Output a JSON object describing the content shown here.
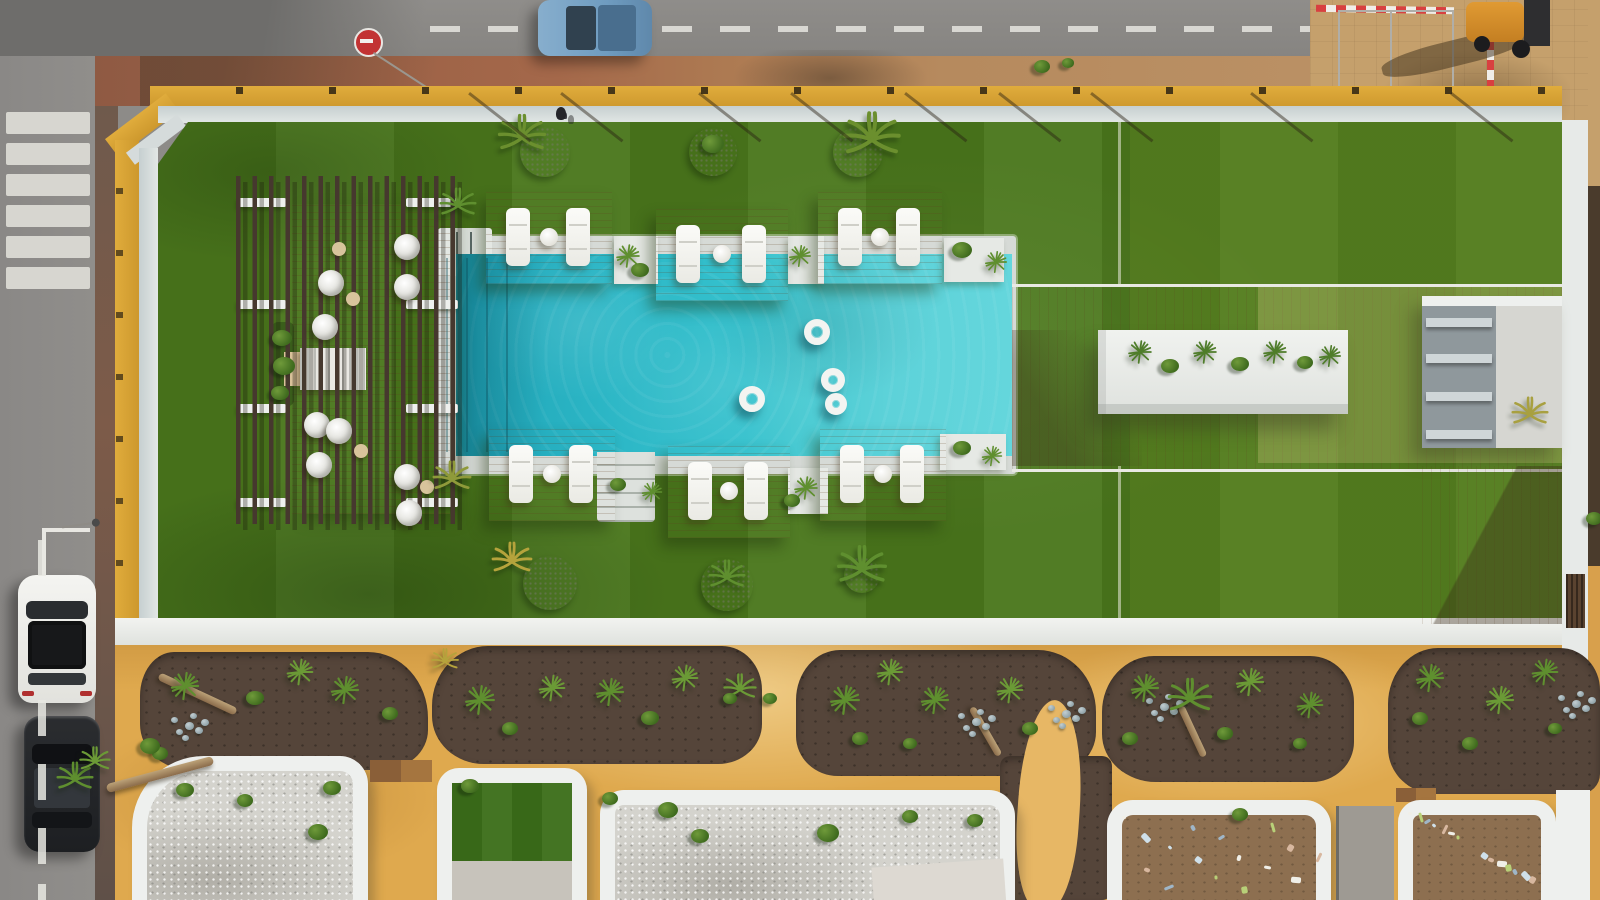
{
  "image": {
    "kind": "aerial-drone-photo",
    "subject": "residential pool courtyard with lawn, pergola lounge, sun-deck platforms, planted beds and street"
  },
  "palette": {
    "road": "#8d8b88",
    "sidewalk_red": "#9d6247",
    "pave_tan": "#c5a06c",
    "wall_ochre": "#d8a435",
    "coping": "#d5dbdb",
    "white": "#eef0ee",
    "grass": "#4a771c",
    "grass_light": "#5d8824",
    "pool_deep": "#2cb7c6",
    "pool_shallow": "#64d6dc",
    "wood": "#c59c6b",
    "slat": "#46382e",
    "sand": "#dfa94e",
    "soil": "#55453a",
    "gravel": "#d4d3cd",
    "dirt": "#8d6f50",
    "structure_gray": "#8f989c",
    "car_blue": "#7da6c8",
    "car_white": "#f4f4f1",
    "car_black": "#26282a",
    "sign_red": "#c23333",
    "float_white": "#f3f4f1",
    "turf": "#3c6e1a"
  },
  "scene": {
    "crosswalk_ys": [
      112,
      143,
      174,
      205,
      236,
      267
    ],
    "road_dash_ys": [
      540,
      700,
      764,
      828,
      884
    ],
    "shadow_lines_x": [
      470,
      562,
      700,
      792,
      906,
      1000,
      1092,
      1252,
      1452
    ],
    "grass_seams": [
      [
        1118,
        122,
        163
      ],
      [
        1118,
        466,
        152
      ]
    ],
    "platforms": [
      [
        486,
        192,
        126,
        92
      ],
      [
        656,
        209,
        132,
        92
      ],
      [
        818,
        192,
        124,
        92
      ],
      [
        489,
        429,
        126,
        92
      ],
      [
        668,
        446,
        122,
        92
      ],
      [
        820,
        429,
        126,
        92
      ]
    ],
    "pockets": [
      [
        614,
        236,
        44,
        48
      ],
      [
        788,
        236,
        36,
        48
      ],
      [
        944,
        238,
        60,
        44
      ],
      [
        788,
        468,
        40,
        46
      ],
      [
        940,
        434,
        66,
        36
      ]
    ],
    "floats": [
      [
        817,
        332,
        26
      ],
      [
        752,
        399,
        26
      ],
      [
        833,
        380,
        24
      ],
      [
        836,
        404,
        22
      ]
    ],
    "lane_lines_x": [
      446,
      466,
      486,
      506
    ],
    "planters_top": [
      [
        545,
        152,
        50
      ],
      [
        713,
        152,
        48
      ],
      [
        858,
        152,
        50
      ]
    ],
    "planters_bottom": [
      [
        550,
        583,
        54
      ],
      [
        727,
        585,
        52
      ],
      [
        862,
        575,
        36
      ]
    ],
    "pergola_chairs": [
      [
        318,
        270
      ],
      [
        394,
        234
      ],
      [
        394,
        274
      ],
      [
        312,
        314
      ],
      [
        304,
        412
      ],
      [
        326,
        418
      ],
      [
        306,
        452
      ],
      [
        394,
        464
      ],
      [
        396,
        500
      ]
    ],
    "pergola_tables": [
      [
        346,
        292
      ],
      [
        354,
        444
      ],
      [
        420,
        480
      ],
      [
        332,
        242
      ]
    ],
    "pergola_beams": [
      [
        238,
        198,
        48
      ],
      [
        238,
        300,
        48
      ],
      [
        238,
        404,
        48
      ],
      [
        238,
        498,
        48
      ],
      [
        406,
        198,
        52
      ],
      [
        406,
        300,
        52
      ],
      [
        406,
        404,
        52
      ],
      [
        406,
        498,
        52
      ]
    ],
    "beds": [
      [
        140,
        652,
        288,
        118
      ],
      [
        432,
        646,
        330,
        118
      ],
      [
        796,
        650,
        300,
        126
      ],
      [
        1102,
        656,
        252,
        126
      ],
      [
        1388,
        648,
        212,
        146
      ]
    ],
    "stones": [
      [
        185,
        722
      ],
      [
        972,
        718
      ],
      [
        1062,
        710
      ],
      [
        1160,
        703
      ],
      [
        1572,
        700
      ]
    ],
    "logs": [
      [
        155,
        690,
        25,
        85,
        8
      ],
      [
        958,
        728,
        60,
        55,
        7
      ],
      [
        1165,
        728,
        65,
        55,
        7
      ],
      [
        105,
        770,
        -15,
        110,
        9
      ]
    ],
    "debris_cells": [
      [
        1122,
        816,
        196,
        72,
        16
      ],
      [
        1408,
        812,
        138,
        78,
        14
      ]
    ],
    "plants": [
      [
        "palm",
        458,
        206,
        40,
        "#5f8f2f"
      ],
      [
        "palm",
        452,
        480,
        42,
        "#8f9a3a"
      ],
      [
        "agave",
        628,
        256,
        30,
        "#5f8f2f"
      ],
      [
        "tuft",
        640,
        272,
        18,
        ""
      ],
      [
        "agave",
        800,
        256,
        28,
        "#5f8f2f"
      ],
      [
        "tuft",
        962,
        252,
        20,
        ""
      ],
      [
        "agave",
        996,
        262,
        28,
        "#5f8f2f"
      ],
      [
        "agave",
        806,
        488,
        30,
        "#5f8f2f"
      ],
      [
        "tuft",
        792,
        502,
        16,
        ""
      ],
      [
        "tuft",
        962,
        450,
        18,
        ""
      ],
      [
        "agave",
        992,
        456,
        26,
        "#5f8f2f"
      ],
      [
        "tuft",
        618,
        486,
        16,
        ""
      ],
      [
        "agave",
        652,
        492,
        26,
        "#5f8f2f"
      ],
      [
        "palm",
        522,
        138,
        52,
        "#6b8f2e"
      ],
      [
        "tuft",
        713,
        146,
        22,
        ""
      ],
      [
        "palm",
        872,
        140,
        62,
        "#6b8f2e"
      ],
      [
        "gold",
        512,
        562,
        44,
        "#b5a33c"
      ],
      [
        "palm",
        727,
        578,
        40,
        "#5f8f2f"
      ],
      [
        "palm",
        862,
        570,
        54,
        "#5f8f2f"
      ],
      [
        "tuft",
        282,
        340,
        20,
        ""
      ],
      [
        "tuft",
        284,
        368,
        22,
        ""
      ],
      [
        "tuft",
        280,
        395,
        18,
        ""
      ],
      [
        "agave",
        185,
        686,
        36,
        "#5f8f2f"
      ],
      [
        "agave",
        300,
        672,
        34,
        "#6b9a36"
      ],
      [
        "agave",
        345,
        690,
        36,
        "#5f8f2f"
      ],
      [
        "agave",
        480,
        700,
        38,
        "#5f8f2f"
      ],
      [
        "agave",
        552,
        688,
        34,
        "#6b9a36"
      ],
      [
        "agave",
        610,
        692,
        36,
        "#5f8f2f"
      ],
      [
        "agave",
        685,
        678,
        34,
        "#6b9a36"
      ],
      [
        "agave",
        845,
        700,
        38,
        "#5f8f2f"
      ],
      [
        "agave",
        890,
        672,
        34,
        "#6b9a36"
      ],
      [
        "agave",
        935,
        700,
        36,
        "#5f8f2f"
      ],
      [
        "agave",
        1010,
        690,
        34,
        "#6b9a36"
      ],
      [
        "agave",
        1145,
        688,
        36,
        "#5f8f2f"
      ],
      [
        "agave",
        1250,
        682,
        36,
        "#6b9a36"
      ],
      [
        "agave",
        1310,
        705,
        34,
        "#5f8f2f"
      ],
      [
        "agave",
        1430,
        678,
        36,
        "#5f8f2f"
      ],
      [
        "agave",
        1500,
        700,
        36,
        "#6b9a36"
      ],
      [
        "agave",
        1545,
        672,
        34,
        "#5f8f2f"
      ],
      [
        "palm",
        1190,
        700,
        48,
        "#5f8f2f"
      ],
      [
        "palm",
        740,
        690,
        36,
        "#6b9a36"
      ],
      [
        "tuft",
        255,
        700,
        18,
        ""
      ],
      [
        "tuft",
        390,
        715,
        16,
        ""
      ],
      [
        "tuft",
        160,
        755,
        16,
        ""
      ],
      [
        "gold",
        445,
        662,
        30,
        "#b5a33c"
      ],
      [
        "tuft",
        510,
        730,
        16,
        ""
      ],
      [
        "tuft",
        650,
        720,
        18,
        ""
      ],
      [
        "tuft",
        730,
        700,
        14,
        ""
      ],
      [
        "tuft",
        860,
        740,
        16,
        ""
      ],
      [
        "tuft",
        910,
        745,
        14,
        ""
      ],
      [
        "tuft",
        1030,
        730,
        16,
        ""
      ],
      [
        "tuft",
        1130,
        740,
        16,
        ""
      ],
      [
        "tuft",
        1225,
        735,
        16,
        ""
      ],
      [
        "tuft",
        1300,
        745,
        14,
        ""
      ],
      [
        "tuft",
        1420,
        720,
        16,
        ""
      ],
      [
        "tuft",
        1470,
        745,
        16,
        ""
      ],
      [
        "tuft",
        1555,
        730,
        14,
        ""
      ],
      [
        "tuft",
        770,
        700,
        14,
        ""
      ],
      [
        "tuft",
        185,
        792,
        18,
        ""
      ],
      [
        "tuft",
        245,
        802,
        16,
        ""
      ],
      [
        "tuft",
        332,
        790,
        18,
        ""
      ],
      [
        "tuft",
        318,
        834,
        20,
        ""
      ],
      [
        "tuft",
        470,
        788,
        18,
        ""
      ],
      [
        "tuft",
        610,
        800,
        16,
        ""
      ],
      [
        "tuft",
        668,
        812,
        20,
        ""
      ],
      [
        "tuft",
        700,
        838,
        18,
        ""
      ],
      [
        "tuft",
        828,
        835,
        22,
        ""
      ],
      [
        "tuft",
        910,
        818,
        16,
        ""
      ],
      [
        "tuft",
        975,
        822,
        16,
        ""
      ],
      [
        "tuft",
        1240,
        816,
        16,
        ""
      ],
      [
        "palm",
        75,
        780,
        40,
        "#5f8f2f"
      ],
      [
        "palm",
        95,
        762,
        34,
        "#6b9a36"
      ],
      [
        "tuft",
        150,
        748,
        20,
        ""
      ],
      [
        "gold",
        1530,
        415,
        40,
        "#a8a040"
      ],
      [
        "tuft",
        1594,
        520,
        16,
        ""
      ],
      [
        "tuft",
        1042,
        68,
        16,
        ""
      ],
      [
        "tuft",
        1068,
        64,
        12,
        ""
      ],
      [
        "agave",
        1140,
        352,
        30,
        "#4f7d2a"
      ],
      [
        "tuft",
        1170,
        368,
        18,
        ""
      ],
      [
        "agave",
        1205,
        352,
        30,
        "#4f7d2a"
      ],
      [
        "tuft",
        1240,
        366,
        18,
        ""
      ],
      [
        "agave",
        1275,
        352,
        30,
        "#4f7d2a"
      ],
      [
        "tuft",
        1305,
        364,
        16,
        ""
      ],
      [
        "agave",
        1330,
        356,
        28,
        "#4f7d2a"
      ]
    ]
  }
}
